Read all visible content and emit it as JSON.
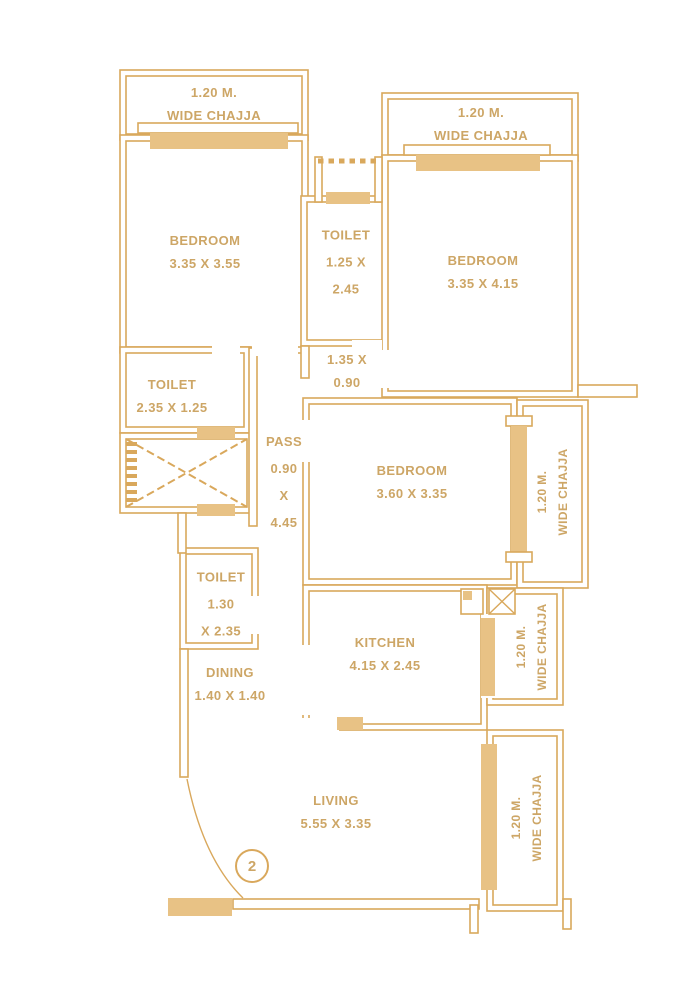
{
  "floor_plan": {
    "unit_number": "2",
    "chajja_top_left": {
      "line1": "1.20 M.",
      "line2": "WIDE CHAJJA"
    },
    "chajja_top_right": {
      "line1": "1.20 M.",
      "line2": "WIDE CHAJJA"
    },
    "chajja_mid_right": {
      "line1": "1.20 M.",
      "line2": "WIDE CHAJJA"
    },
    "chajja_kitchen": {
      "line1": "1.20 M.",
      "line2": "WIDE CHAJJA"
    },
    "chajja_bottom_right": {
      "line1": "1.20 M.",
      "line2": "WIDE CHAJJA"
    },
    "bedroom_top_left": {
      "name": "BEDROOM",
      "dims": "3.35 X 3.55"
    },
    "bedroom_top_right": {
      "name": "BEDROOM",
      "dims": "3.35 X 4.15"
    },
    "bedroom_mid": {
      "name": "BEDROOM",
      "dims": "3.60 X 3.35"
    },
    "toilet_top": {
      "name": "TOILET",
      "dims_line1": "1.25 X",
      "dims_line2": "2.45"
    },
    "toilet_left": {
      "name": "TOILET",
      "dims": "2.35 X 1.25"
    },
    "toilet_lower": {
      "name": "TOILET",
      "dims_line1": "1.30",
      "dims_line2": "X  2.35"
    },
    "kitchen": {
      "name": "KITCHEN",
      "dims": "4.15 X 2.45"
    },
    "dining": {
      "name": "DINING",
      "dims": "1.40 X 1.40"
    },
    "living": {
      "name": "LIVING",
      "dims": "5.55 X 3.35"
    },
    "pass": {
      "line1": "PASS",
      "line2": "0.90",
      "line3": "X",
      "line4": "4.45"
    },
    "lobby": {
      "line1": "1.35 X",
      "line2": "0.90"
    },
    "colors": {
      "wall": "#D9A85C",
      "window_fill": "#E8C285",
      "label_text": "#CDA666",
      "background": "#FFFFFF"
    }
  }
}
